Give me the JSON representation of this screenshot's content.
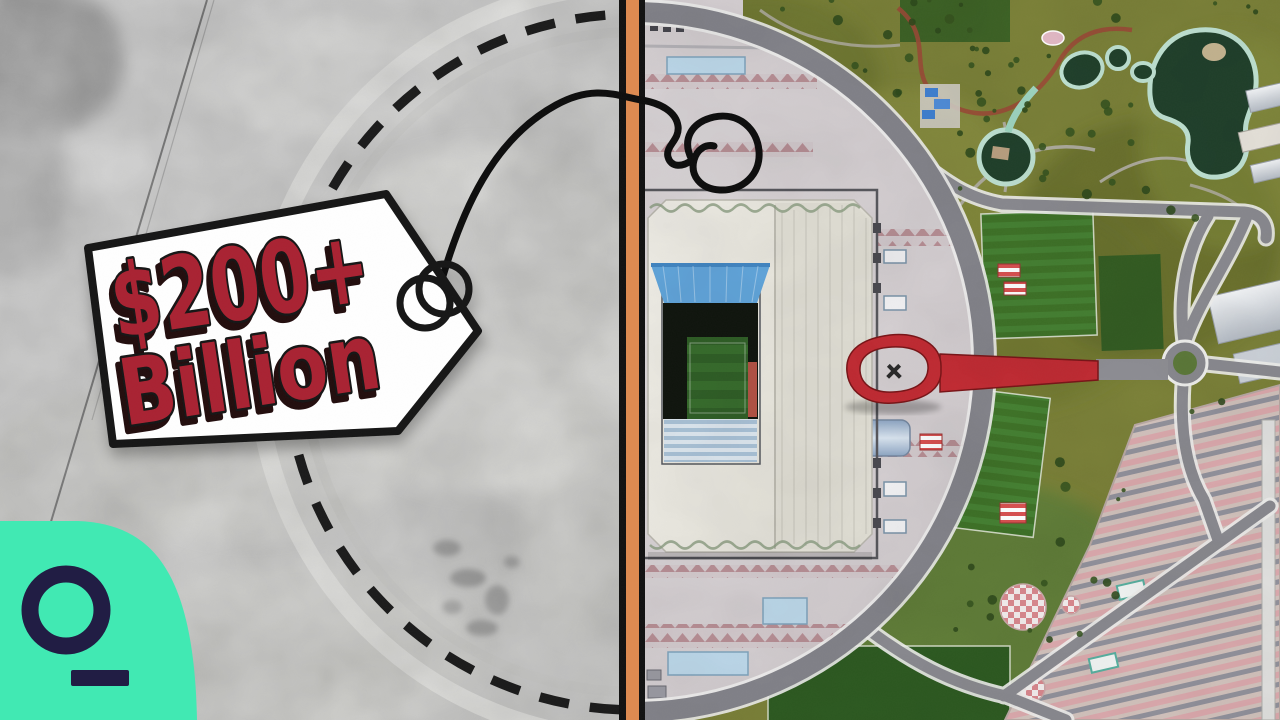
{
  "scene": {
    "left_pane_alt": "grayscale satellite view of empty desert construction site",
    "right_pane_alt": "color aerial satellite view of stadium complex with park, ponds, ring road and parking",
    "divider_color": "#de8a50"
  },
  "price_tag": {
    "line1": "$200+",
    "line2": "Billion",
    "text_color": "#a92431",
    "outline_color": "#141414",
    "tag_fill": "#ffffff"
  },
  "brand_logo": {
    "name": "quicktake-logo",
    "background": "#41e9b3",
    "glyph_color": "#211d44"
  },
  "palette": {
    "plaza": "#d7d1d4",
    "park_green": "#7b8138",
    "road_gray": "#84848b",
    "stadium_roof": "#ebe9e1",
    "pitch_green": "#2f5e26",
    "stand_blue": "#60a4da",
    "water_dark": "#20402b",
    "pond_edge_mint": "#bfe2d2",
    "sculpture_red": "#c22b33",
    "parking_pink": "#d8abad",
    "dashed_outline": "#0e0e0e"
  }
}
